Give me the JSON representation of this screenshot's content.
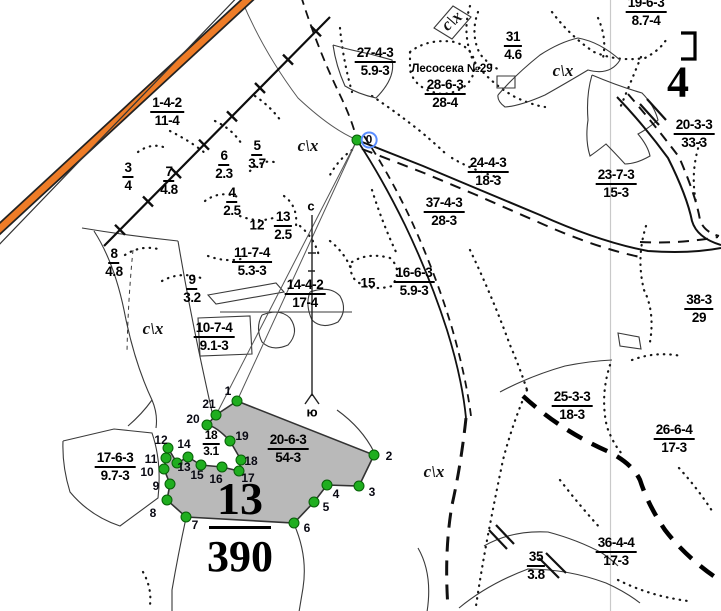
{
  "map": {
    "colors": {
      "road_orange": "#ee7c27",
      "vertex_green": "#1fae1f",
      "vertex_green_border": "#075f07",
      "selected_parcel_fill": "#b9b9b9",
      "highlight_blue": "#5a8dff"
    },
    "compass": {
      "north": "с",
      "south": "ю",
      "north_x": 311,
      "north_y": 206,
      "south_x": 312,
      "south_y": 412
    },
    "big_numeral": {
      "text": "4",
      "x": 678,
      "y": 82
    },
    "big_fraction": {
      "num": "13",
      "den": "390",
      "x": 240,
      "y": 477
    },
    "lesoseka": {
      "text": "Лесосека №29",
      "x": 452,
      "y": 69
    },
    "land_use_labels": [
      {
        "text": "с\\х",
        "x": 452,
        "y": 21,
        "rotate": -40
      },
      {
        "text": "с\\х",
        "x": 563,
        "y": 71
      },
      {
        "text": "с\\х",
        "x": 308,
        "y": 146
      },
      {
        "text": "с\\х",
        "x": 153,
        "y": 329
      },
      {
        "text": "с\\х",
        "x": 434,
        "y": 472
      }
    ],
    "parcel_fractions": [
      {
        "top": "1-4-2",
        "bottom": "11-4",
        "x": 167,
        "y": 95
      },
      {
        "top": "3",
        "bottom": "4",
        "x": 128,
        "y": 160
      },
      {
        "top": "7",
        "bottom": "4.8",
        "x": 169,
        "y": 164
      },
      {
        "top": "5",
        "bottom": "3.7",
        "x": 257,
        "y": 138
      },
      {
        "top": "6",
        "bottom": "2.3",
        "x": 224,
        "y": 148
      },
      {
        "top": "4",
        "bottom": "2.5",
        "x": 232,
        "y": 185
      },
      {
        "top": "13",
        "bottom": "2.5",
        "x": 283,
        "y": 209
      },
      {
        "top": "11-7-4",
        "bottom": "5.3-3",
        "x": 252,
        "y": 245
      },
      {
        "top": "9",
        "bottom": "3.2",
        "x": 192,
        "y": 272
      },
      {
        "top": "8",
        "bottom": "4.8",
        "x": 114,
        "y": 246
      },
      {
        "top": "10-7-4",
        "bottom": "9.1-3",
        "x": 214,
        "y": 320
      },
      {
        "top": "14-4-2",
        "bottom": "17-4",
        "x": 305,
        "y": 277
      },
      {
        "top": "16-6-3",
        "bottom": "5.9-3",
        "x": 414,
        "y": 265
      },
      {
        "top": "37-4-3",
        "bottom": "28-3",
        "x": 444,
        "y": 195
      },
      {
        "top": "24-4-3",
        "bottom": "18-3",
        "x": 488,
        "y": 155
      },
      {
        "top": "27-4-3",
        "bottom": "5.9-3",
        "x": 375,
        "y": 45
      },
      {
        "top": "28-6-3",
        "bottom": "28-4",
        "x": 445,
        "y": 77
      },
      {
        "top": "31",
        "bottom": "4.6",
        "x": 513,
        "y": 29
      },
      {
        "top": "19-6-3",
        "bottom": "8.7-4",
        "x": 646,
        "y": -5
      },
      {
        "top": "20-3-3",
        "bottom": "33-3",
        "x": 694,
        "y": 117
      },
      {
        "top": "23-7-3",
        "bottom": "15-3",
        "x": 616,
        "y": 167
      },
      {
        "top": "38-3",
        "bottom": "29",
        "x": 699,
        "y": 292
      },
      {
        "top": "25-3-3",
        "bottom": "18-3",
        "x": 572,
        "y": 389
      },
      {
        "top": "26-6-4",
        "bottom": "17-3",
        "x": 674,
        "y": 422
      },
      {
        "top": "36-4-4",
        "bottom": "17-3",
        "x": 616,
        "y": 535
      },
      {
        "top": "35",
        "bottom": "3.8",
        "x": 536,
        "y": 549
      },
      {
        "top": "17-6-3",
        "bottom": "9.7-3",
        "x": 115,
        "y": 450
      },
      {
        "top": "20-6-3",
        "bottom": "54-3",
        "x": 288,
        "y": 432
      },
      {
        "top": "18",
        "bottom": "3.1",
        "x": 211,
        "y": 429,
        "small": true
      }
    ],
    "single_numbers": [
      {
        "text": "12",
        "x": 257,
        "y": 225
      },
      {
        "text": "15",
        "x": 368,
        "y": 283
      }
    ],
    "vertices": [
      {
        "n": "0",
        "x": 357,
        "y": 140,
        "lx": 369,
        "ly": 140,
        "hl": true
      },
      {
        "n": "1",
        "x": 237,
        "y": 401,
        "lx": 228,
        "ly": 391
      },
      {
        "n": "2",
        "x": 374,
        "y": 455,
        "lx": 389,
        "ly": 456
      },
      {
        "n": "3",
        "x": 359,
        "y": 486,
        "lx": 372,
        "ly": 492
      },
      {
        "n": "4",
        "x": 327,
        "y": 485,
        "lx": 336,
        "ly": 494
      },
      {
        "n": "5",
        "x": 314,
        "y": 502,
        "lx": 326,
        "ly": 507
      },
      {
        "n": "6",
        "x": 294,
        "y": 523,
        "lx": 307,
        "ly": 528
      },
      {
        "n": "7",
        "x": 186,
        "y": 517,
        "lx": 195,
        "ly": 525
      },
      {
        "n": "8",
        "x": 167,
        "y": 500,
        "lx": 153,
        "ly": 513
      },
      {
        "n": "9",
        "x": 170,
        "y": 484,
        "lx": 156,
        "ly": 486
      },
      {
        "n": "10",
        "x": 164,
        "y": 469,
        "lx": 147,
        "ly": 472
      },
      {
        "n": "11",
        "x": 166,
        "y": 458,
        "lx": 151,
        "ly": 459
      },
      {
        "n": "12",
        "x": 168,
        "y": 448,
        "lx": 161,
        "ly": 440
      },
      {
        "n": "13",
        "x": 177,
        "y": 463,
        "lx": 184,
        "ly": 467
      },
      {
        "n": "14",
        "x": 188,
        "y": 457,
        "lx": 184,
        "ly": 444
      },
      {
        "n": "15",
        "x": 201,
        "y": 465,
        "lx": 197,
        "ly": 475
      },
      {
        "n": "16",
        "x": 222,
        "y": 467,
        "lx": 216,
        "ly": 479
      },
      {
        "n": "17",
        "x": 239,
        "y": 471,
        "lx": 248,
        "ly": 478
      },
      {
        "n": "18",
        "x": 241,
        "y": 460,
        "lx": 251,
        "ly": 461
      },
      {
        "n": "19",
        "x": 230,
        "y": 441,
        "lx": 242,
        "ly": 436
      },
      {
        "n": "20",
        "x": 207,
        "y": 425,
        "lx": 193,
        "ly": 419
      },
      {
        "n": "21",
        "x": 216,
        "y": 415,
        "lx": 209,
        "ly": 404
      }
    ]
  }
}
